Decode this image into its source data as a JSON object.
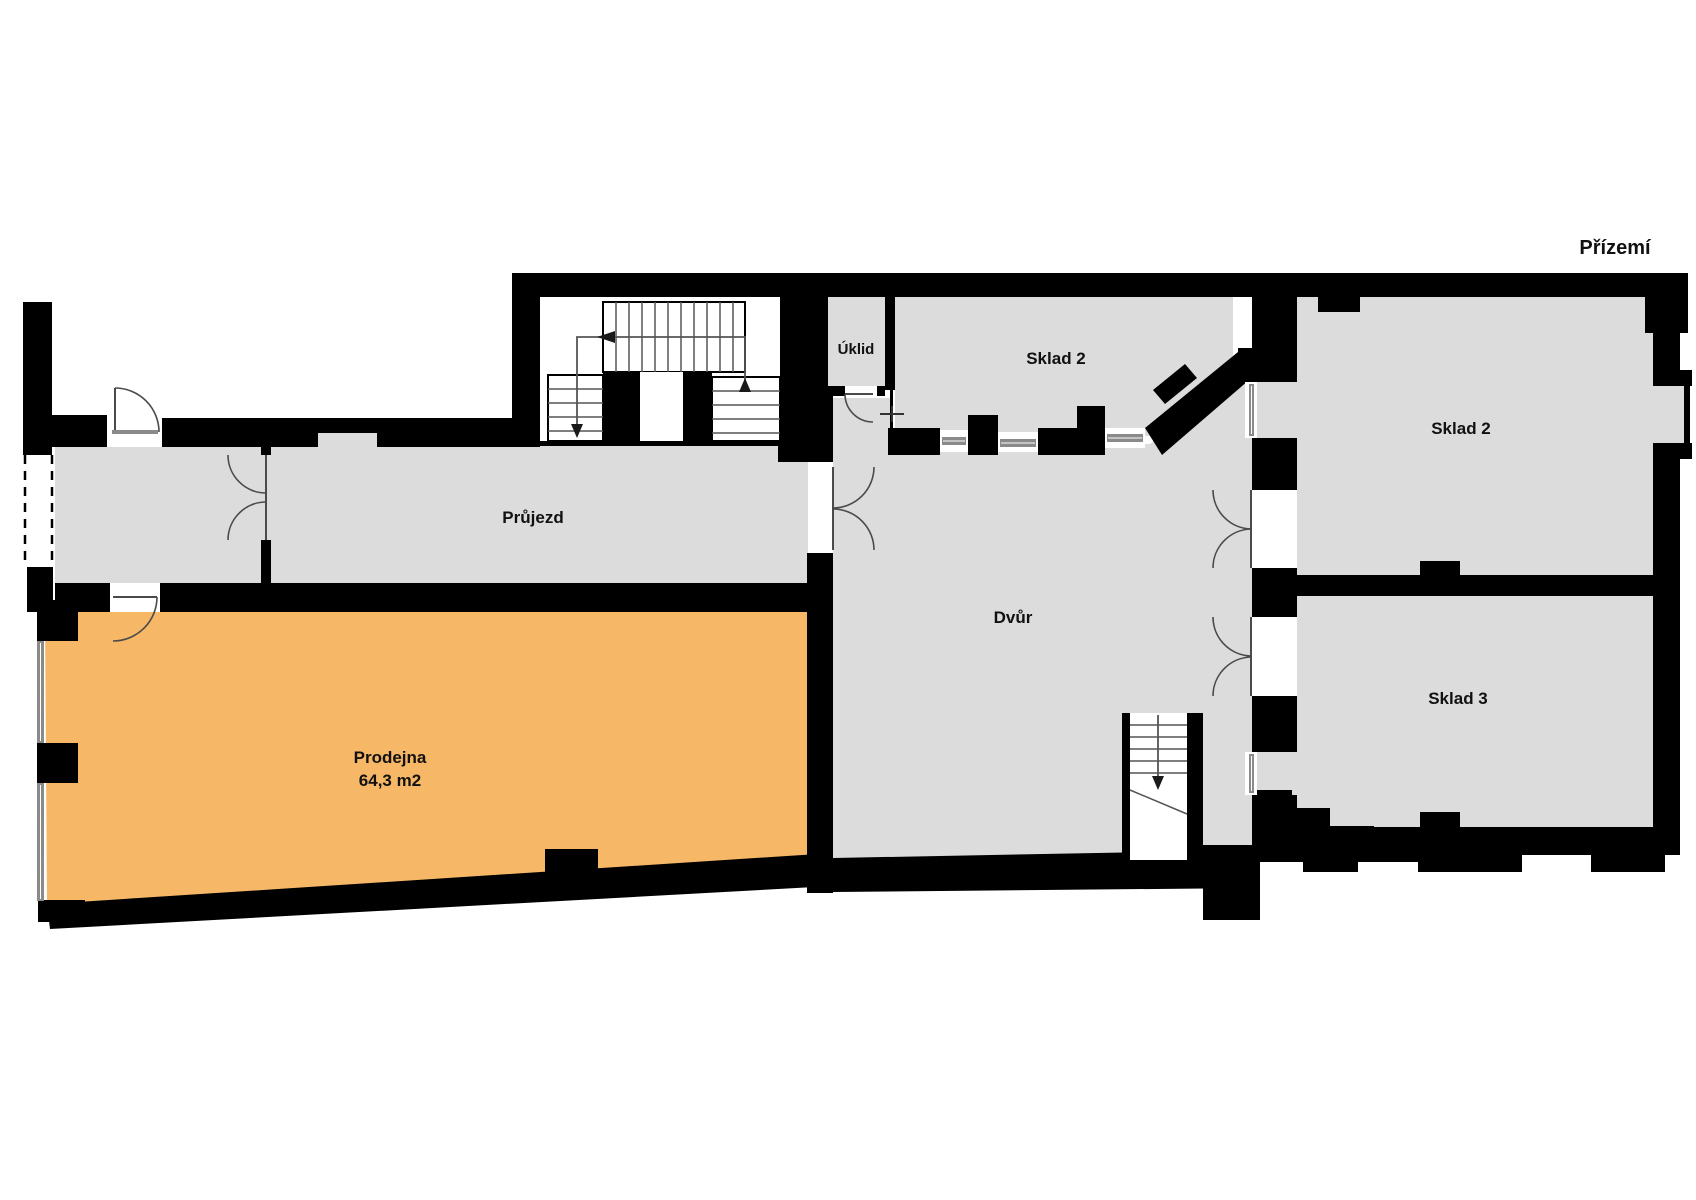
{
  "title": "Přízemí",
  "rooms": {
    "prujezd": {
      "label": "Průjezd"
    },
    "uklid": {
      "label": "Úklid"
    },
    "sklad2_top": {
      "label": "Sklad 2"
    },
    "sklad2_right": {
      "label": "Sklad 2"
    },
    "sklad3": {
      "label": "Sklad 3"
    },
    "dvur": {
      "label": "Dvůr"
    },
    "prodejna": {
      "label": "Prodejna",
      "area": "64,3 m2"
    }
  },
  "colors": {
    "wall": "#000000",
    "room_fill": "#dcdcdc",
    "highlight_fill": "#f6b766",
    "line": "#4a4a4a",
    "glazing": "#8a8a8a"
  }
}
